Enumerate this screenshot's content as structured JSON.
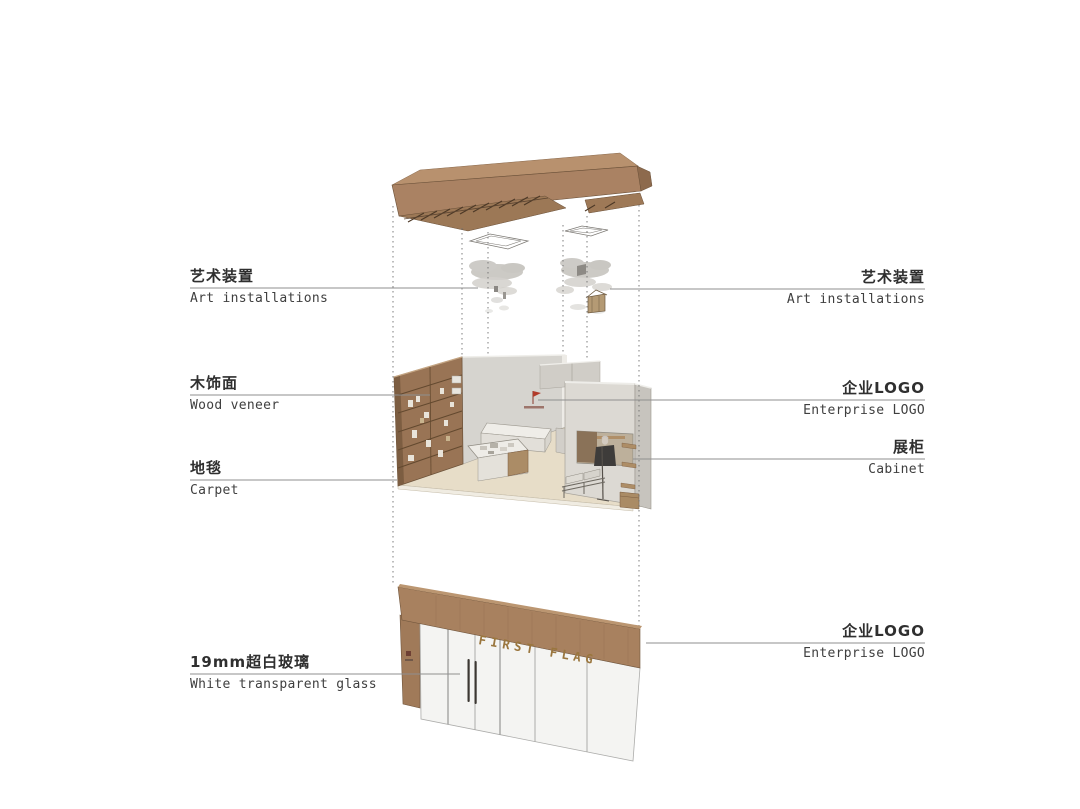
{
  "labels": {
    "left": [
      {
        "zh": "艺术装置",
        "en": "Art installations"
      },
      {
        "zh": "木饰面",
        "en": "Wood veneer"
      },
      {
        "zh": "地毯",
        "en": "Carpet"
      },
      {
        "zh": "19mm超白玻璃",
        "en": "White transparent glass"
      }
    ],
    "right": [
      {
        "zh": "艺术装置",
        "en": "Art installations"
      },
      {
        "zh": "企业LOGO",
        "en": "Enterprise LOGO"
      },
      {
        "zh": "展柜",
        "en": "Cabinet"
      },
      {
        "zh": "企业LOGO",
        "en": "Enterprise LOGO"
      }
    ]
  },
  "storefront": {
    "sign_text": "FIRST FLAG"
  },
  "colors": {
    "wood": "#a8815f",
    "wood_dark": "#7c5d41",
    "wall_grey": "#d6d4cf",
    "floor_beige": "#e7ddc8",
    "logo_red": "#b23b2a",
    "sign_gold": "#9a763e",
    "leader_line": "#8f8f8f",
    "text": "#2f2f2f"
  }
}
